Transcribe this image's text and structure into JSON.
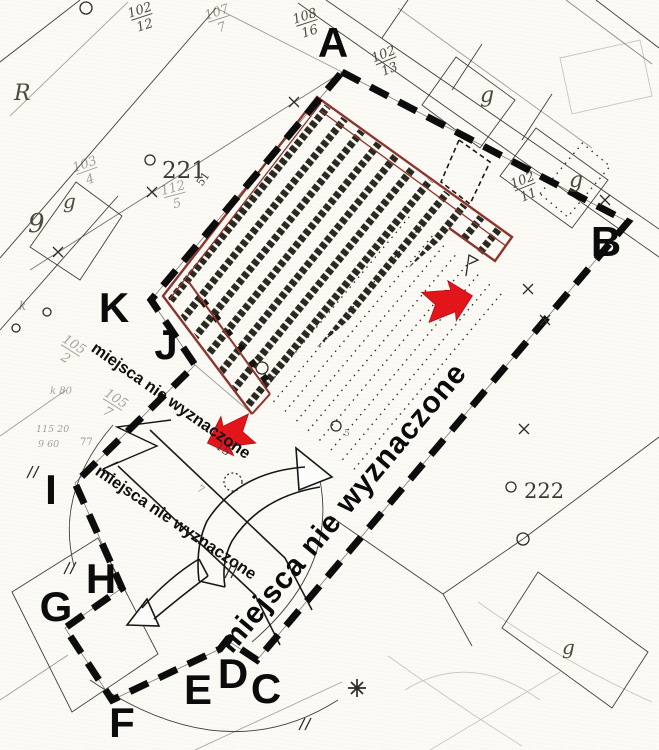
{
  "map": {
    "description": "Scanned cadastral site plan of a marketplace with investigation boundary A-K, red-outlined market hall, red locator arrows and annotations",
    "paper_color": "#fbfaf5",
    "ink_color": "#40403a",
    "boundary": {
      "color": "#0c0c0c",
      "labels": [
        {
          "label": "A"
        },
        {
          "label": "B"
        },
        {
          "label": "C"
        },
        {
          "label": "D"
        },
        {
          "label": "E"
        },
        {
          "label": "F"
        },
        {
          "label": "G"
        },
        {
          "label": "H"
        },
        {
          "label": "I"
        },
        {
          "label": "J"
        },
        {
          "label": "K"
        }
      ]
    },
    "building": {
      "outline_color": "#8c352c"
    },
    "arrows": {
      "color": "#e3151b",
      "items": [
        {
          "name": "red-arrow-east"
        },
        {
          "name": "red-arrow-southwest"
        }
      ]
    },
    "notes": [
      {
        "text": "miejsca nie wyznaczone",
        "style": "small"
      },
      {
        "text": "miejsca nie wyznaczone",
        "style": "small"
      },
      {
        "text": "miejsca nie wyznaczone",
        "style": "large"
      }
    ],
    "parcel_labels": [
      {
        "num": "102",
        "den": "12"
      },
      {
        "num": "107",
        "den": "7"
      },
      {
        "num": "108",
        "den": "16"
      },
      {
        "num": "102",
        "den": "13"
      },
      {
        "num": "102",
        "den": "11"
      },
      {
        "num": "103",
        "den": "4"
      },
      {
        "num": "112",
        "den": "5"
      },
      {
        "num": "105",
        "den": "2"
      },
      {
        "num": "105",
        "den": "7"
      }
    ],
    "area_labels": [
      {
        "text": "R"
      },
      {
        "text": "g"
      },
      {
        "text": "9"
      },
      {
        "text": "g"
      },
      {
        "text": "g"
      },
      {
        "text": "g"
      },
      {
        "text": "221"
      },
      {
        "text": "222"
      },
      {
        "text": "k"
      },
      {
        "text": "51"
      },
      {
        "text": "15"
      },
      {
        "text": "7"
      },
      {
        "text": "77"
      },
      {
        "text": "115 20"
      },
      {
        "text": "9 60"
      },
      {
        "text": "k 80"
      },
      {
        "text": "5"
      }
    ]
  }
}
